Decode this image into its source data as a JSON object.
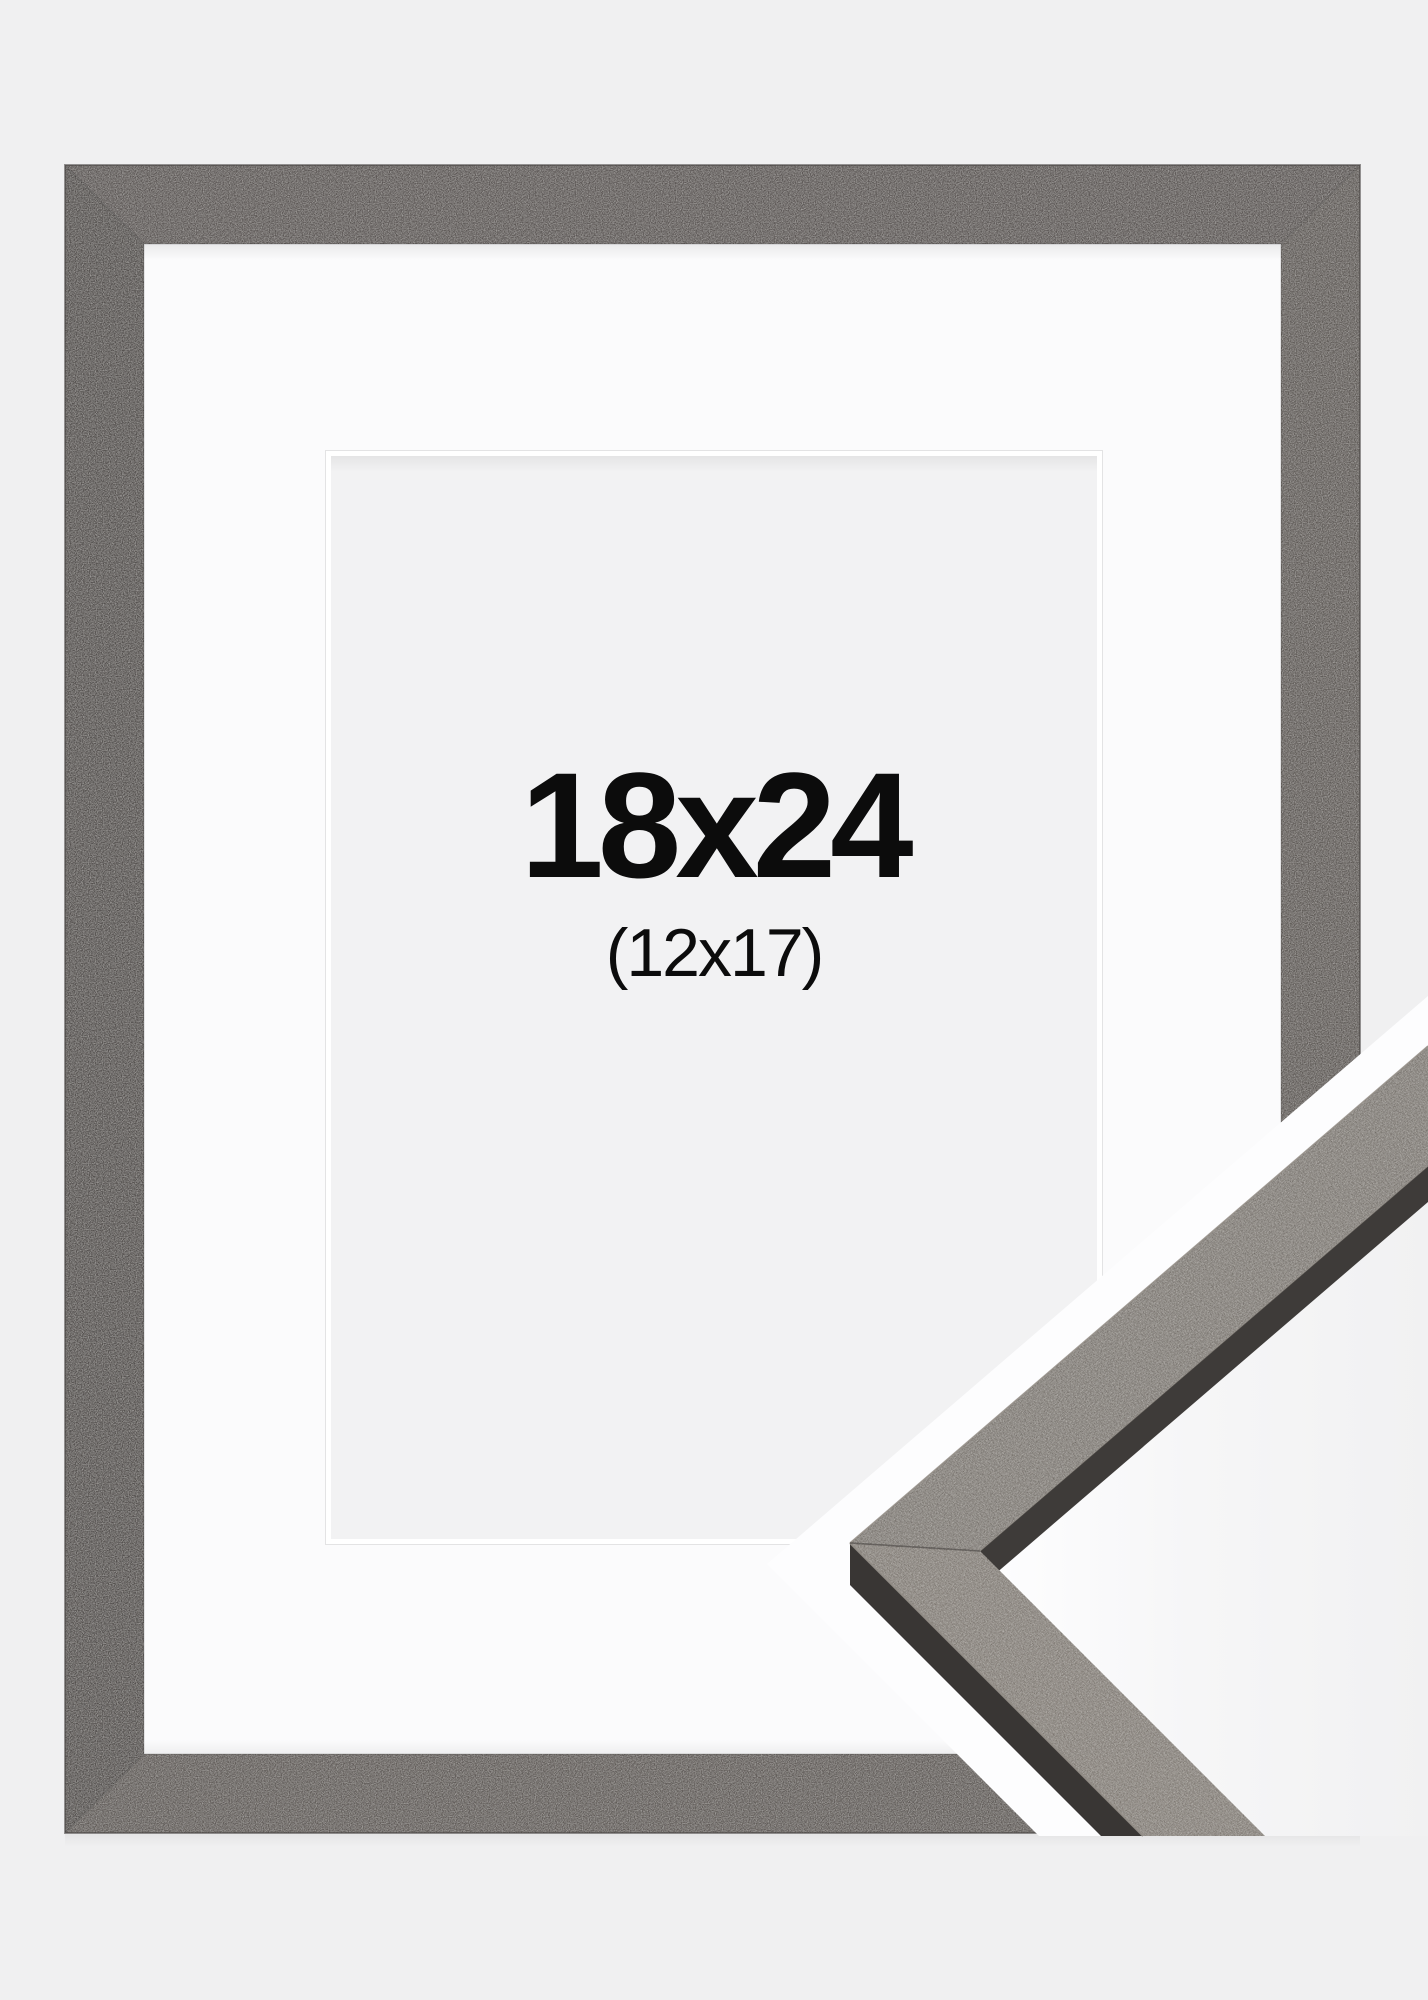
{
  "product": {
    "size_label": "18x24",
    "inner_size_label": "(12x17)"
  },
  "colors": {
    "background": "#f0f0f1",
    "frame_top": "#5d5856",
    "frame_right": "#615c59",
    "frame_bottom": "#625d5a",
    "frame_left": "#555150",
    "frame_outline": "#45413f",
    "mat": "#fbfbfc",
    "bevel_hairline": "#e3e3e4",
    "bevel": "#ffffff",
    "opening": "#f2f2f3",
    "text": "#0c0c0c",
    "band_white": "#fdfdfe",
    "sample_face_upper": "#6e6963",
    "sample_face_lower": "#746e67",
    "sample_side_dark": "#3e3b39",
    "sample_side_darker": "#393634",
    "sample_edge_light": "#948e87"
  }
}
